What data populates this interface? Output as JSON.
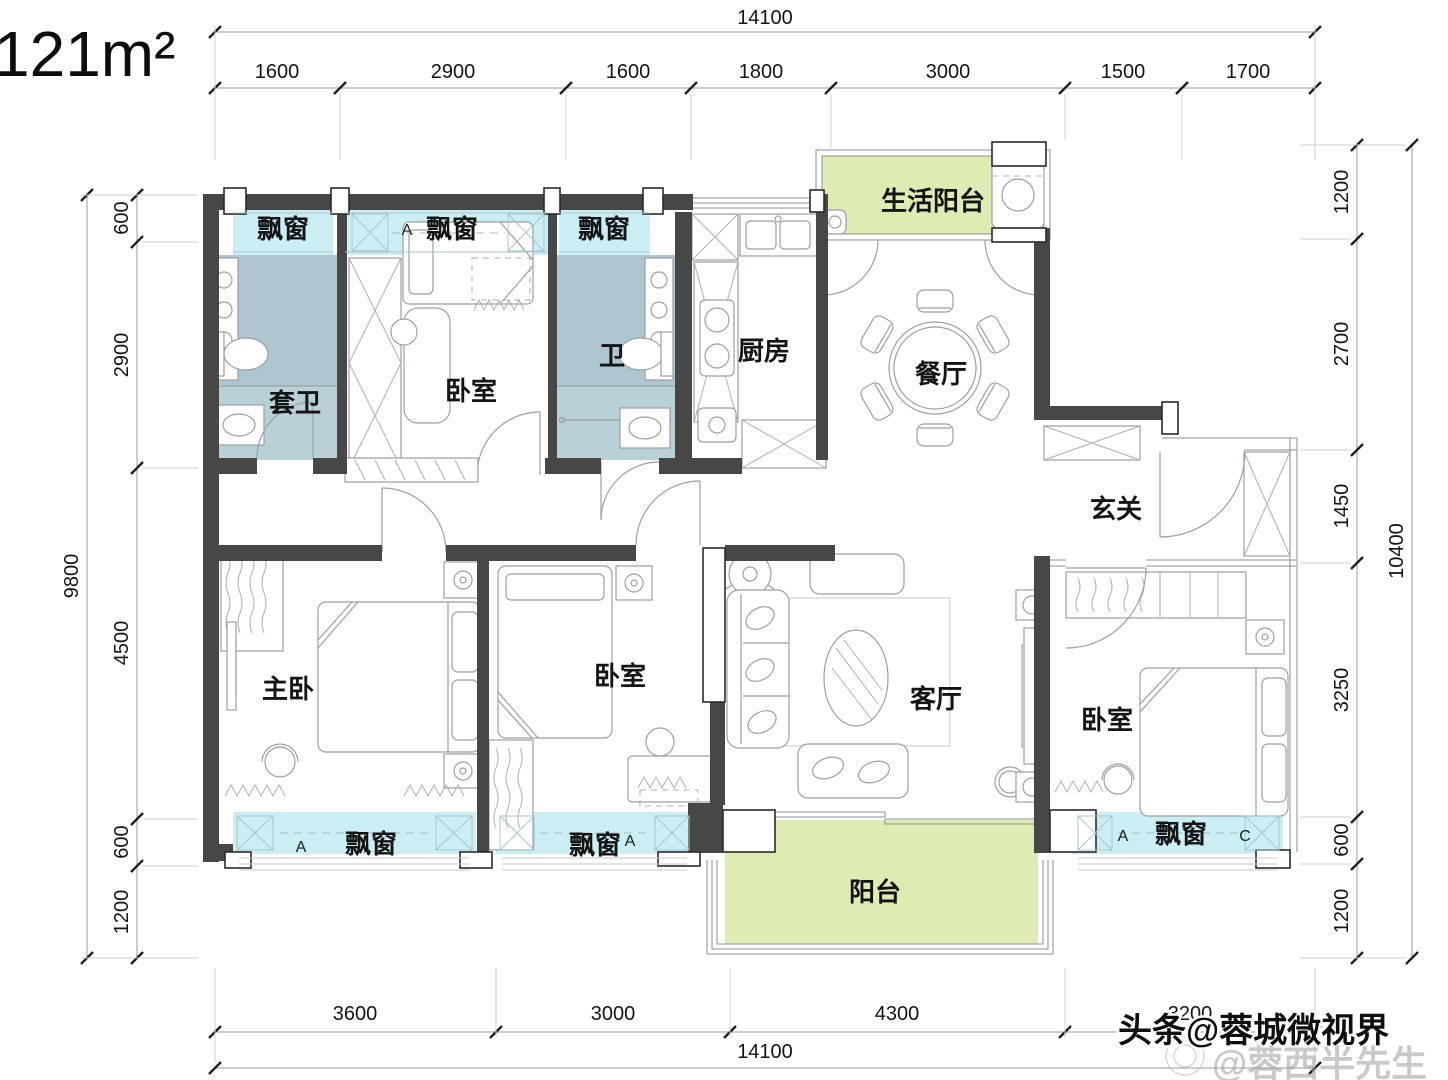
{
  "title": {
    "area": "121m²"
  },
  "dimensions": {
    "top": {
      "overall": "14100",
      "segments": [
        "1600",
        "2900",
        "1600",
        "1800",
        "3000",
        "1500",
        "1700"
      ]
    },
    "bottom": {
      "overall": "14100",
      "segments": [
        "3600",
        "3000",
        "4300",
        "3200"
      ]
    },
    "left": {
      "overall": "9800",
      "segments": [
        "600",
        "2900",
        "4500",
        "600",
        "1200"
      ]
    },
    "right": {
      "overall": "10400",
      "segments": [
        "1200",
        "2700",
        "1450",
        "3250",
        "600",
        "1200"
      ]
    }
  },
  "rooms": {
    "bay_window": "飘窗",
    "ensuite_bath": "套卫",
    "bedroom": "卧室",
    "bath": "卫",
    "kitchen": "厨房",
    "dining": "餐厅",
    "service_balcony": "生活阳台",
    "entry": "玄关",
    "master_bedroom": "主卧",
    "living_room": "客厅",
    "balcony": "阳台"
  },
  "window_marks": {
    "a": "A",
    "c": "C"
  },
  "watermark": {
    "line1": "头条@蓉城微视界",
    "line2": "@蓉西半先生"
  },
  "colors": {
    "wall": "#474747",
    "bay_window": "#cbedf4",
    "bathroom_upper": "#adc6cf",
    "bathroom_lower": "#bad0d7",
    "balcony": "#dcecb2",
    "line": "#9aa0a6"
  }
}
